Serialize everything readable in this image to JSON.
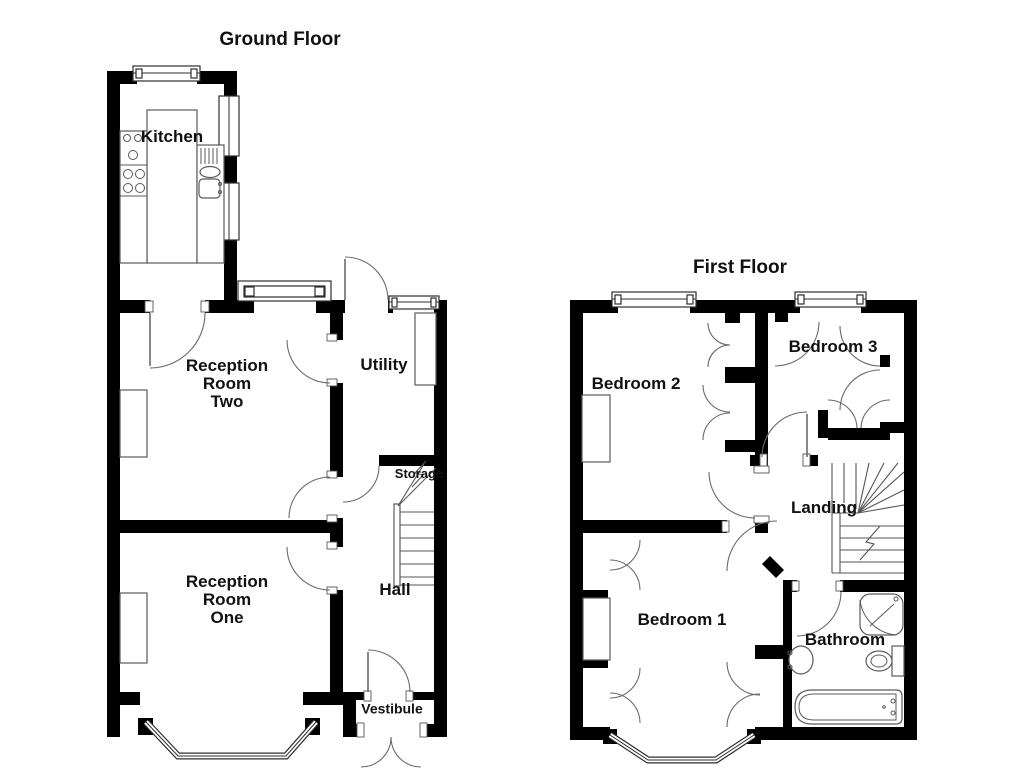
{
  "colors": {
    "wall": "#000000",
    "line": "#5f5f5f",
    "text": "#111111",
    "background": "#ffffff"
  },
  "floors": [
    {
      "title": "Ground Floor",
      "rooms": [
        {
          "label": "Kitchen"
        },
        {
          "label": "Reception\nRoom\nTwo"
        },
        {
          "label": "Utility"
        },
        {
          "label": "Storage"
        },
        {
          "label": "Hall"
        },
        {
          "label": "Reception\nRoom\nOne"
        },
        {
          "label": "Vestibule"
        }
      ],
      "fixtures": [
        "hob",
        "kitchen-sink",
        "worktops",
        "stairs",
        "bay-window",
        "front-double-door"
      ]
    },
    {
      "title": "First Floor",
      "rooms": [
        {
          "label": "Bedroom 2"
        },
        {
          "label": "Bedroom 3"
        },
        {
          "label": "Landing"
        },
        {
          "label": "Bedroom 1"
        },
        {
          "label": "Bathroom"
        }
      ],
      "fixtures": [
        "shower",
        "wash-basin",
        "toilet",
        "bathtub",
        "stairs",
        "bay-window",
        "wardrobes"
      ]
    }
  ]
}
